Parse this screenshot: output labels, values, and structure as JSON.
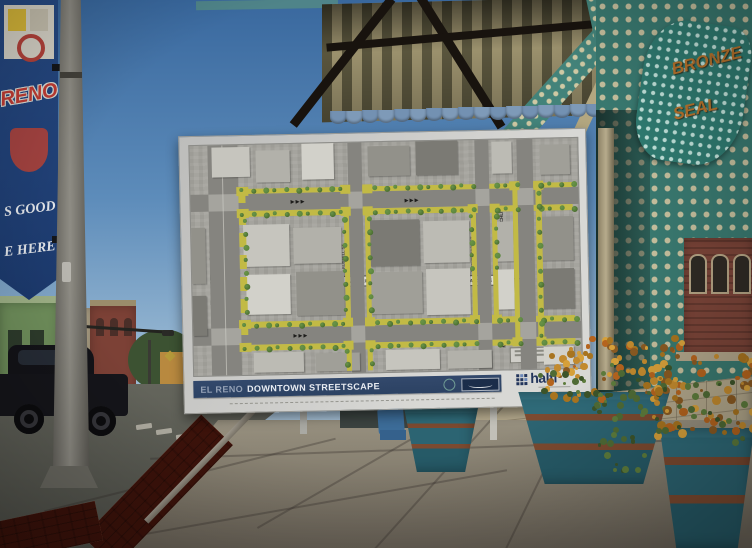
{
  "poster": {
    "title_prefix": "EL RENO",
    "title_main": "DOWNTOWN STREETSCAPE",
    "firm_logo_text": "halff",
    "map_labels": {
      "route66": "ROUTE 66",
      "bickford_left": "S BICKFORD AVE",
      "bickford_right": "S BICKFORD AVE",
      "rock_island_left": "ROCK ISLAND AVE",
      "rock_island_right": "ROCK ISLAND AVE",
      "matchline_a_left": "MATCHLINE A",
      "matchline_a_right": "MATCHLINE A",
      "matchline_d_top": "MATCHLINE D",
      "matchline_d_bottom": "MATCHLINE D",
      "russell_st": "S RUSSELL ST",
      "henderson_st": "S HENDERSON ST"
    }
  },
  "photo": {
    "pole_banner": {
      "line1": "RENO",
      "line2": "S GOOD",
      "line3": "E HERE"
    },
    "storefront_sign": {
      "line1": "BRONZE",
      "line2": "SEAL"
    }
  },
  "icons": {
    "halff_grid": "grid-of-squares",
    "bar_seal": "circular-seal",
    "bar_signature": "signature-plaque"
  },
  "colors": {
    "streetscape-yellow": "#c2ba45",
    "title-bar-navy": "#2c4263",
    "halff-navy": "#23355c",
    "wall-teal": "#39786f",
    "sign-orange": "#b5722c",
    "planter-teal": "#2c6472"
  }
}
